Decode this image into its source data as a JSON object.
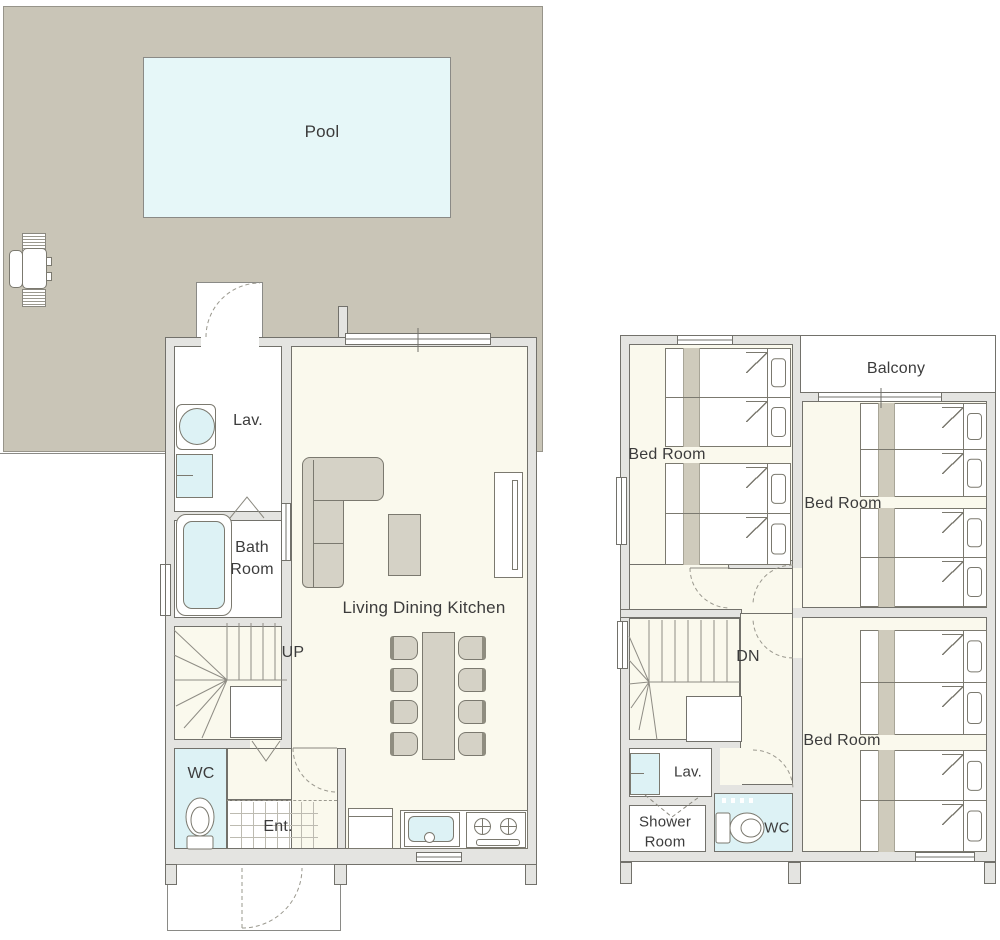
{
  "title": "Two-storey house floor plan with pool",
  "colors": {
    "deck": "#c9c5b7",
    "pool": "#e6f7f8",
    "floor": "#faf9ed",
    "water": "#ddf2f5",
    "wall_fill": "#e4e4e1",
    "wall_line": "#72716b",
    "line": "#8a887f",
    "furniture": "#d5d2c6",
    "bed_stripe": "#cfcbbc",
    "text": "#3c3c3c"
  },
  "floors": {
    "first": {
      "labels": {
        "pool": "Pool",
        "lav": "Lav.",
        "bath1": "Bath",
        "bath2": "Room",
        "ldk": "Living Dining Kitchen",
        "up": "UP",
        "wc": "WC",
        "ent": "Ent."
      }
    },
    "second": {
      "labels": {
        "balcony": "Balcony",
        "bedroom1": "Bed Room",
        "bedroom2": "Bed Room",
        "bedroom3": "Bed Room",
        "dn": "DN",
        "lav": "Lav.",
        "shower1": "Shower",
        "shower2": "Room",
        "wc": "WC"
      }
    }
  },
  "icons": [
    "pool",
    "patio-set-icon",
    "sink-icon",
    "washing-machine-icon",
    "bathtub-icon",
    "toilet-icon",
    "stairs-icon",
    "closet",
    "sofa-icon",
    "coffee-table-icon",
    "tv-board-icon",
    "dining-table-icon",
    "chair-icon",
    "refrigerator-icon",
    "kitchen-sink-icon",
    "stove-icon",
    "bed-icon",
    "pillow-icon",
    "door-arc-icon",
    "folding-door-icon",
    "window-icon"
  ]
}
